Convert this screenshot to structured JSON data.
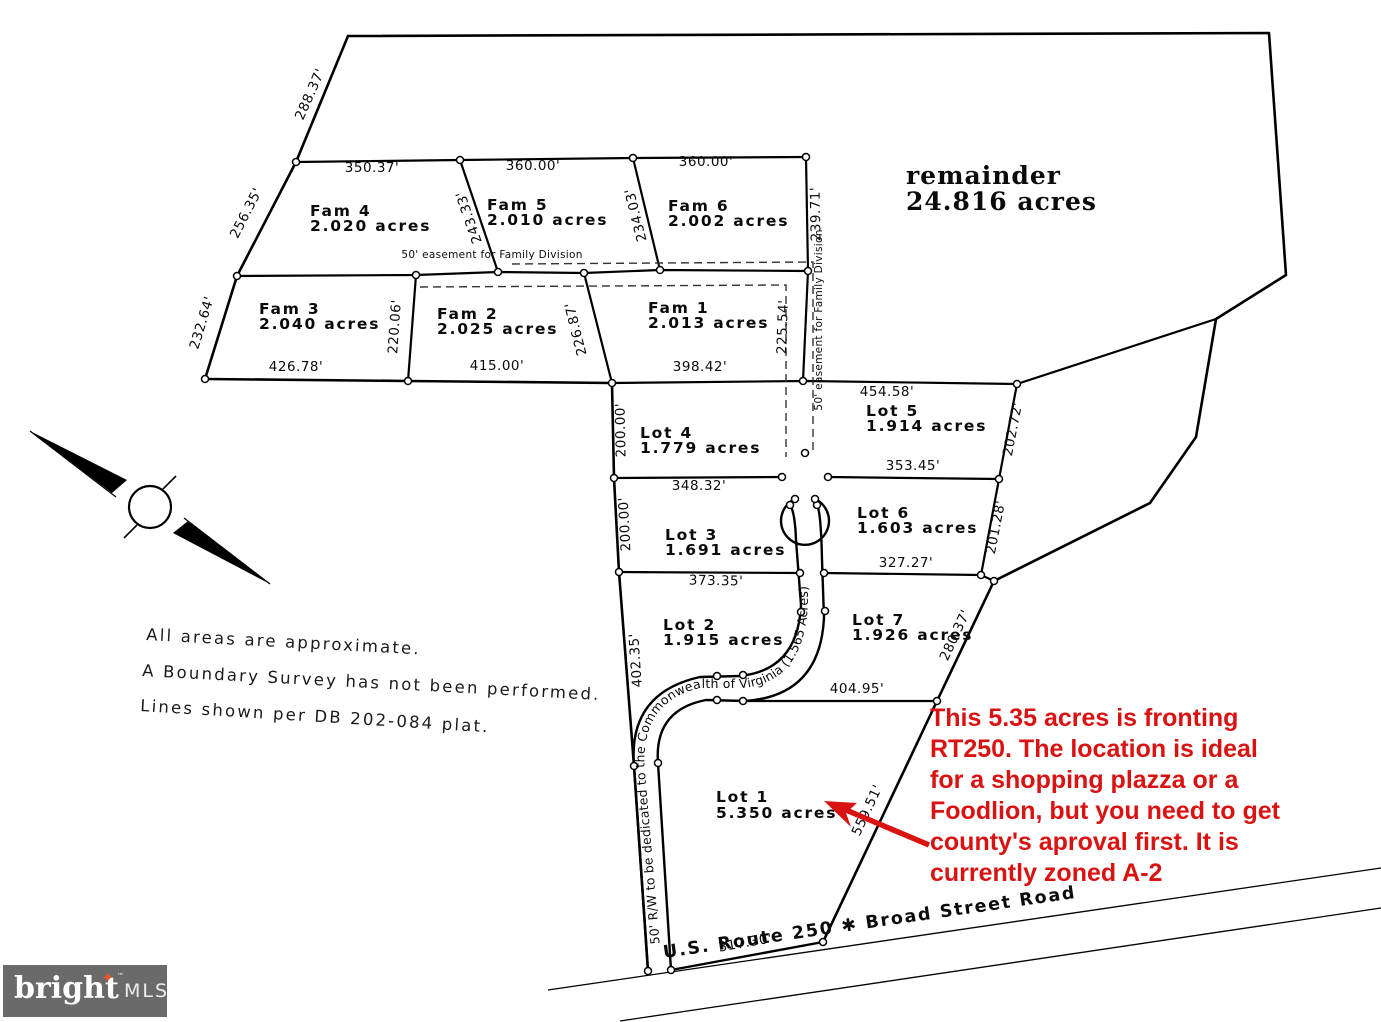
{
  "remainder": {
    "name": "remainder",
    "acres": "24.816 acres"
  },
  "lots": {
    "fam4": {
      "name": "Fam 4",
      "acres": "2.020 acres"
    },
    "fam5": {
      "name": "Fam 5",
      "acres": "2.010 acres"
    },
    "fam6": {
      "name": "Fam 6",
      "acres": "2.002 acres"
    },
    "fam3": {
      "name": "Fam 3",
      "acres": "2.040 acres"
    },
    "fam2": {
      "name": "Fam 2",
      "acres": "2.025 acres"
    },
    "fam1": {
      "name": "Fam 1",
      "acres": "2.013 acres"
    },
    "lot4": {
      "name": "Lot 4",
      "acres": "1.779 acres"
    },
    "lot3": {
      "name": "Lot 3",
      "acres": "1.691 acres"
    },
    "lot2": {
      "name": "Lot 2",
      "acres": "1.915 acres"
    },
    "lot1": {
      "name": "Lot 1",
      "acres": "5.350 acres"
    },
    "lot5": {
      "name": "Lot 5",
      "acres": "1.914 acres"
    },
    "lot6": {
      "name": "Lot 6",
      "acres": "1.603 acres"
    },
    "lot7": {
      "name": "Lot 7",
      "acres": "1.926 acres"
    }
  },
  "dims": {
    "boundary_nw": "288.37'",
    "fam4_top": "350.37'",
    "fam5_top": "360.00'",
    "fam6_top": "360.00'",
    "fam4_west": "256.35'",
    "fam4_east": "243.33'",
    "fam5_east": "234.03'",
    "fam6_east": "239.71'",
    "fam3_west": "232.64'",
    "fam3_east": "220.06'",
    "fam2_east": "226.87'",
    "fam1_east": "225.54'",
    "fam3_bottom": "426.78'",
    "fam2_bottom": "415.00'",
    "fam1_bottom": "398.42'",
    "lot5_top": "454.58'",
    "lot5_east": "202.72'",
    "lot5_bottom": "353.45'",
    "lot6_east": "201.28'",
    "lot6_bottom": "327.27'",
    "lot7_east": "280.37'",
    "lot7_bottom": "404.95'",
    "lot4_west": "200.00'",
    "lot3_west": "200.00'",
    "lot4_bottom": "348.32'",
    "lot3_bottom": "373.35'",
    "lot2_west": "402.35'",
    "lot1_east": "559.51'",
    "lot1_bottom": "317.30'"
  },
  "easement": {
    "label": "50' easement for Family Division"
  },
  "road": {
    "rw_label": "50' R/W to be dedicated to the Commonwealth of Virginia (1.565 Acres)",
    "highway_label": "U.S. Route 250  ✱  Broad Street Road"
  },
  "notes": {
    "line1": "All areas are approximate.",
    "line2": "A Boundary Survey has not been performed.",
    "line3": "Lines shown per DB 202-084 plat."
  },
  "annotation": {
    "color": "#d91212",
    "lines": [
      "This 5.35 acres is fronting",
      "RT250. The location is ideal",
      "for a shopping plazza or a",
      "Foodlion, but you need to get",
      "county's aproval first. It is",
      "currently zoned A-2"
    ]
  },
  "logo": {
    "brand": "bright",
    "tm": "™",
    "star": "✦",
    "suffix": "MLS"
  },
  "colors": {
    "annotation_red": "#d91212",
    "logo_bg": "#6a6a6a",
    "logo_star": "#e0592b",
    "lines": "#000000"
  }
}
